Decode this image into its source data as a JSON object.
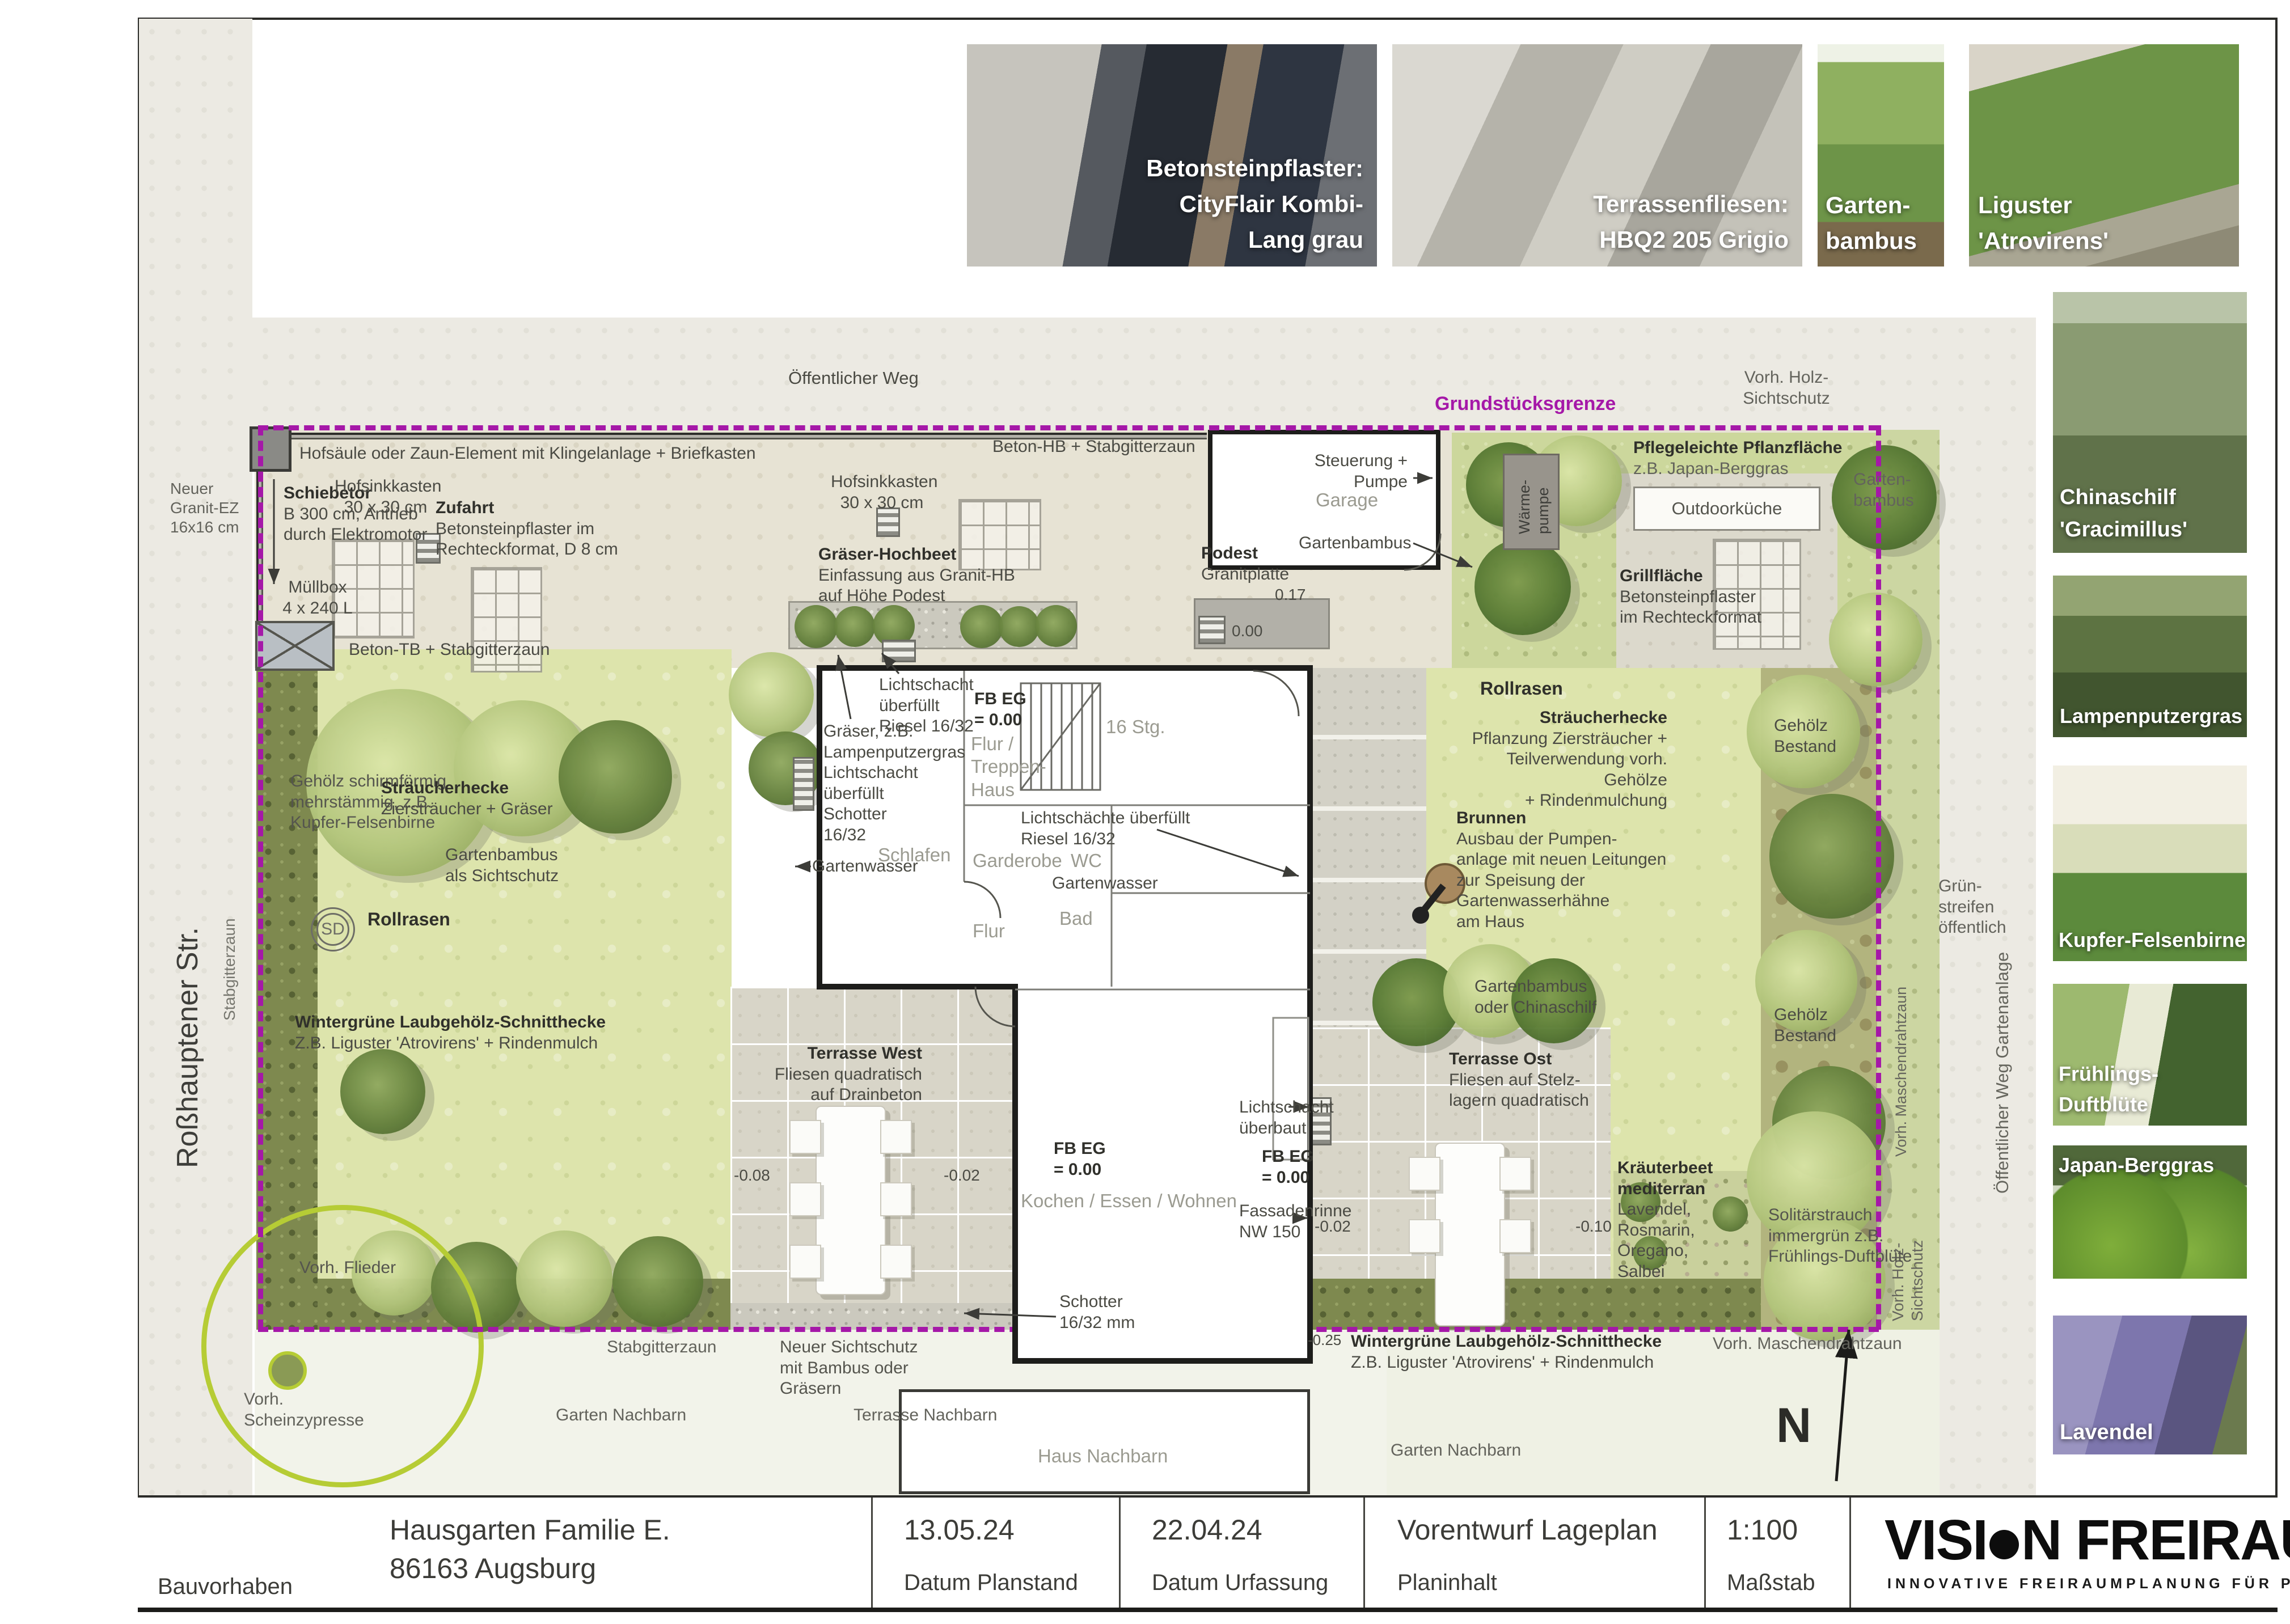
{
  "title_block": {
    "bauvorhaben_label": "Bauvorhaben",
    "project_line1": "Hausgarten Familie E.",
    "project_line2": "86163 Augsburg",
    "planstand_date": "13.05.24",
    "planstand_label": "Datum Planstand",
    "urfassung_date": "22.04.24",
    "urfassung_label": "Datum Urfassung",
    "planinhalt_value": "Vorentwurf Lageplan",
    "planinhalt_label": "Planinhalt",
    "massstab_value": "1:100",
    "massstab_label": "Maßstab",
    "logo_before_dot": "VISI",
    "logo_after_dot": "N FREIRAUM",
    "logo_tagline": "INNOVATIVE FREIRAUMPLANUNG FÜR PRIVAT & GEWERBE"
  },
  "photo_strip": {
    "p1_caption": "Betonsteinpflaster:\nCityFlair Kombi-\nLang grau",
    "p2_caption": "Terrassenfliesen:\nHBQ2 205 Grigio",
    "p3_caption": "Garten-\nbambus",
    "p4_caption": "Liguster\n'Atrovirens'"
  },
  "sidebar": {
    "s1": "Chinaschilf\n'Gracimillus'",
    "s2": "Lampenputzergras",
    "s3": "Kupfer-Felsenbirne",
    "s4": "Frühlings-Duftblüte",
    "s5": "Japan-Berggras",
    "s6": "Lavendel"
  },
  "plan": {
    "labels": {
      "rosshauptener": "Roßhauptener Str.",
      "stabgitterzaun_links": "Stabgitterzaun",
      "granit": "Neuer\nGranit-EZ\n16x16 cm",
      "oeffentlicher_weg": "Öffentlicher Weg",
      "vorh_holz_top": "Vorh. Holz-\nSichtschutz",
      "grundstuecksgrenze": "Grundstücksgrenze",
      "beton_hb": "Beton-HB + Stabgitterzaun",
      "hofsaeule": "Hofsäule oder Zaun-Element mit Klingelanlage + Briefkasten",
      "schiebetor_t": "Schiebetor",
      "schiebetor_b": "B 300 cm, Antrieb\ndurch Elektromotor",
      "hofsink": "Hofsinkkasten\n30 x 30 cm",
      "zufahrt_t": "Zufahrt",
      "zufahrt_b": "Betonsteinpflaster im\nRechteckformat, D 8 cm",
      "muellbox": "Müllbox\n4 x 240 L",
      "beton_tb": "Beton-TB + Stabgitterzaun",
      "hochbeet_t": "Gräser-Hochbeet",
      "hochbeet_b": "Einfassung aus Granit-HB\nauf Höhe Podest",
      "podest_t": "Podest",
      "podest_b": "Granitplatte",
      "p017": "0.17",
      "p000": "0.00",
      "garage": "Garage",
      "steuerung": "Steuerung +\nPumpe",
      "waermepumpe": "Wärme-\npumpe",
      "bambus_garage": "Gartenbambus",
      "pflege_t": "Pflegeleichte Pflanzfläche",
      "pflege_b": "z.B. Japan-Berggras",
      "bambus_rechts": "Garten-\nbambus",
      "outdoor": "Outdoorküche",
      "grill_t": "Grillfläche",
      "grill_b": "Betonsteinpflaster\nim Rechteckformat",
      "rollrasen": "Rollrasen",
      "hecke_r_t": "Sträucherhecke",
      "hecke_r_b": "Pflanzung Ziersträucher +\nTeilverwendung vorh. Gehölze\n+ Rindenmulchung",
      "gehoelz": "Gehölz\nBestand",
      "gruenstreifen": "Grün-\nstreifen\nöffentlich",
      "weg_gartenanlage": "Öffentlicher Weg Gartenanlage",
      "maschendraht_v": "Vorh. Maschendrahtzaun",
      "holz_v": "Vorh. Holz-\nSichtschutz",
      "brunnen_t": "Brunnen",
      "brunnen_b": "Ausbau der Pumpen-\nanlage mit neuen Leitungen\nzur Speisung der\nGartenwasserhähne\nam Haus",
      "bambus_china": "Gartenbambus\noder Chinaschilf",
      "hecke_l_t": "Sträucherhecke",
      "hecke_l_b": "Ziersträucher + Gräser",
      "bambus_sicht": "Gartenbambus\nals Sichtschutz",
      "sd": "SD",
      "gehoelz_schirm": "Gehölz schirmförmig\nmehrstämmig, z.B.\nKupfer-Felsenbirne",
      "wintergruen_t": "Wintergrüne Laubgehölz-Schnitthecke",
      "wintergruen_b": "Z.B. Liguster 'Atrovirens' + Rindenmulch",
      "ls_riesel": "Lichtschacht\nüberfüllt\nRiesel 16/32",
      "graeser_lampen": "Gräser, z.B.\nLampenputzergras",
      "ls_schotter": "Lichtschacht\nüberfüllt\nSchotter\n16/32",
      "gartenwasser": "Gartenwasser",
      "schlafen": "Schlafen",
      "fbeg": "FB EG\n= 0.00",
      "flur_treppe": "Flur /\nTreppen-\nHaus",
      "stg": "16 Stg.",
      "ls_ueberfuellt": "Lichtschächte überfüllt\nRiesel 16/32",
      "wc": "WC",
      "garderobe": "Garderobe",
      "bad": "Bad",
      "flur": "Flur",
      "kochen": "Kochen / Essen / Wohnen",
      "m008": "-0.08",
      "m002": "-0.02",
      "m010": "-0.10",
      "m025": "-0.25",
      "fassadenrinne": "Fassadenrinne\nNW 150",
      "ls_ueberbaut": "Lichtschacht\nüberbaut",
      "schotter_mm": "Schotter\n16/32 mm",
      "tw_t": "Terrasse West",
      "tw_b": "Fliesen quadratisch\nauf Drainbeton",
      "to_t": "Terrasse Ost",
      "to_b": "Fliesen auf Stelz-\nlagern quadratisch",
      "kraut_t": "Kräuterbeet\nmediterran",
      "kraut_b": "Lavendel,\nRosmarin,\nOregano,\nSalbei",
      "solitaer": "Solitärstrauch\nimmergrün z.B.\nFrühlings-Duftblüte",
      "flieder": "Vorh. Flieder",
      "zypresse": "Vorh.\nScheinzypresse",
      "stabgitter_u": "Stabgitterzaun",
      "sichtschutz_neu": "Neuer Sichtschutz\nmit Bambus oder\nGräsern",
      "garten_nachbarn": "Garten Nachbarn",
      "terrasse_nachbarn": "Terrasse Nachbarn",
      "haus_nachbarn": "Haus Nachbarn",
      "maschendraht_u": "Vorh. Maschendrahtzaun",
      "north": "N"
    }
  }
}
